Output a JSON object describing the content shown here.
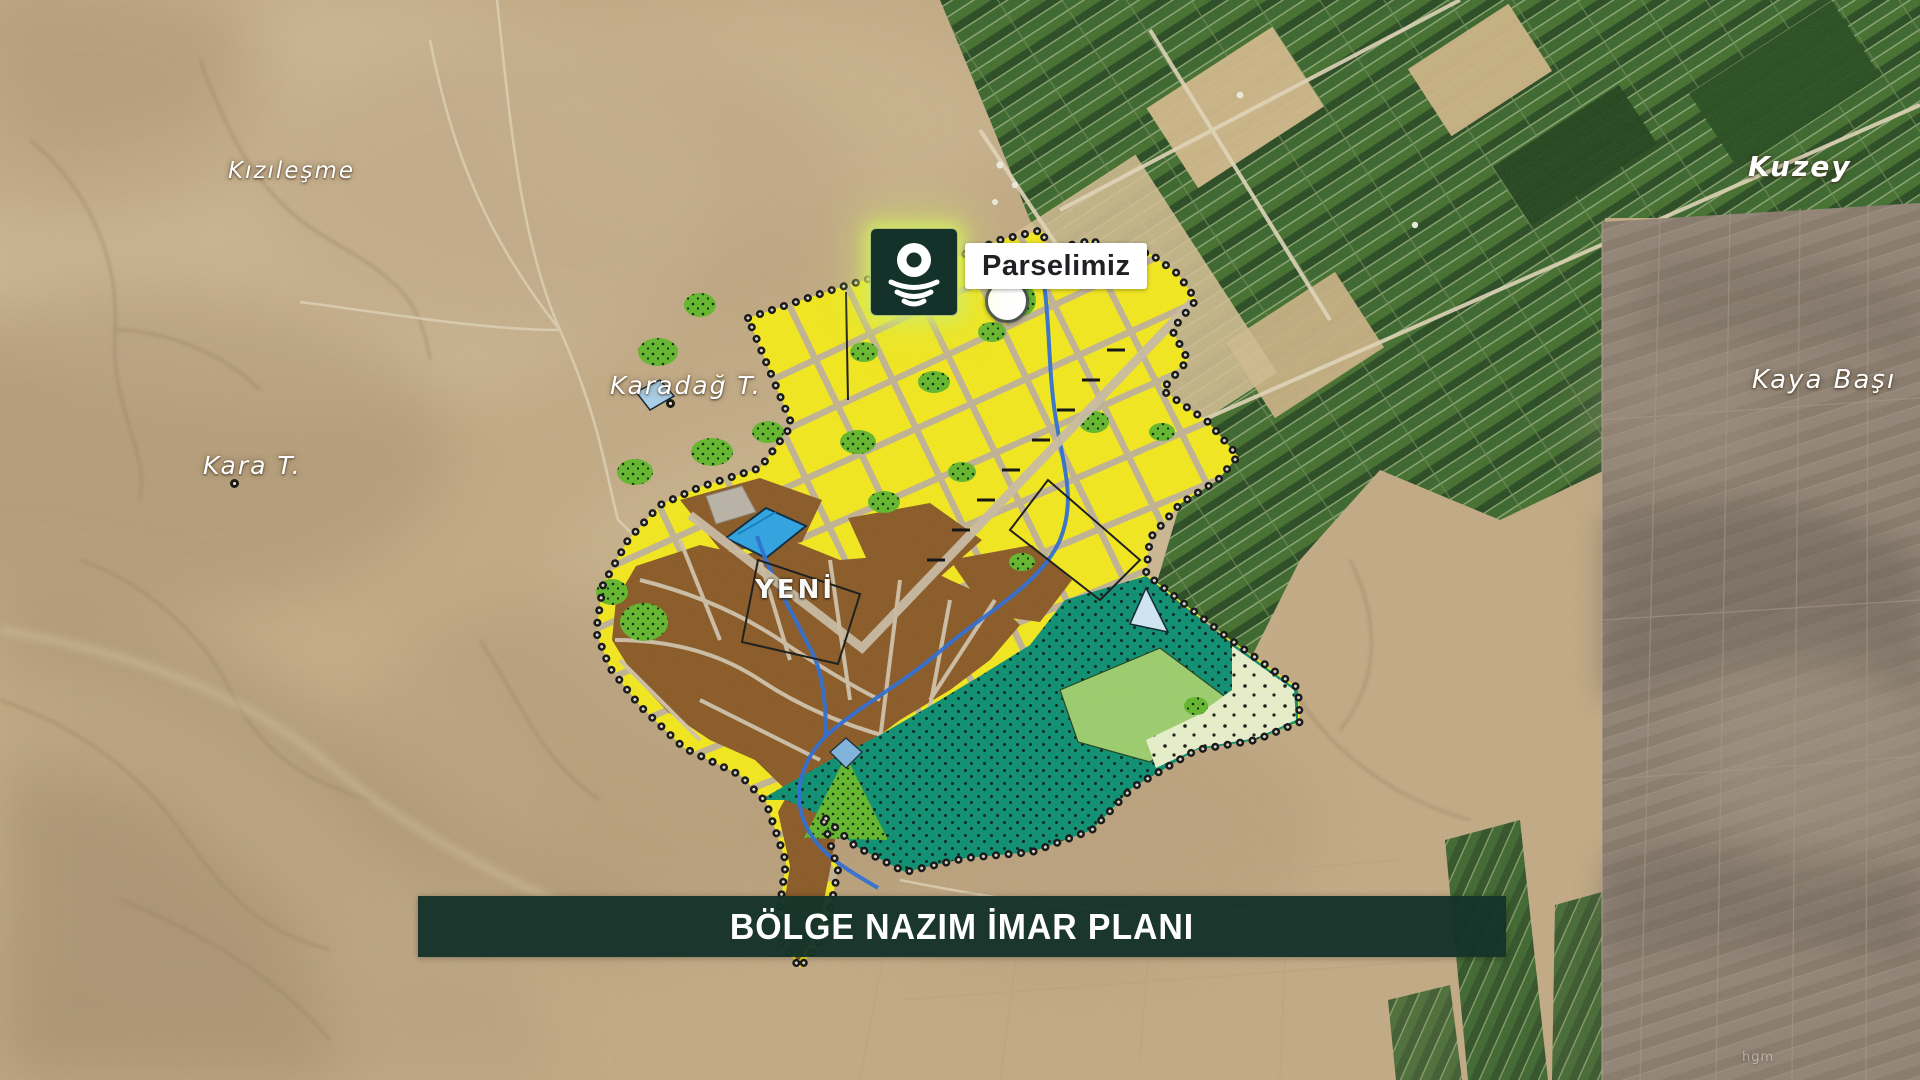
{
  "banner": {
    "title": "BÖLGE NAZIM İMAR PLANI",
    "background_color": "#16342A",
    "text_color": "#FFFFFF"
  },
  "callout": {
    "label": "Parselimiz",
    "icon": "field-location-pin-icon",
    "icon_background": "#14312A",
    "glow_color": "#D4EB62"
  },
  "place_labels": {
    "kizilesme": "Kızıleşme",
    "karadag": "Karadağ T.",
    "kara": "Kara T.",
    "kuzey": "Kuzey",
    "kayabasi": "Kaya Başı",
    "town": "YENİ",
    "watermark": "hgm"
  },
  "plan_overlay": {
    "name": "Bölge Nazım İmar Planı",
    "parcel_marker": "white-circle",
    "zone_colors": {
      "planned_development_yellow": "#F2E71D",
      "existing_settlement_brown": "#8A5A26",
      "green_area_teal": "#0D8F71",
      "agriculture_light_green": "#9CCD6D",
      "afforestation_pale": "#E7EEC9",
      "water_blue": "#2FA3E0",
      "road_gray": "#BEB09A",
      "boundary_beads_black": "#141414"
    }
  }
}
